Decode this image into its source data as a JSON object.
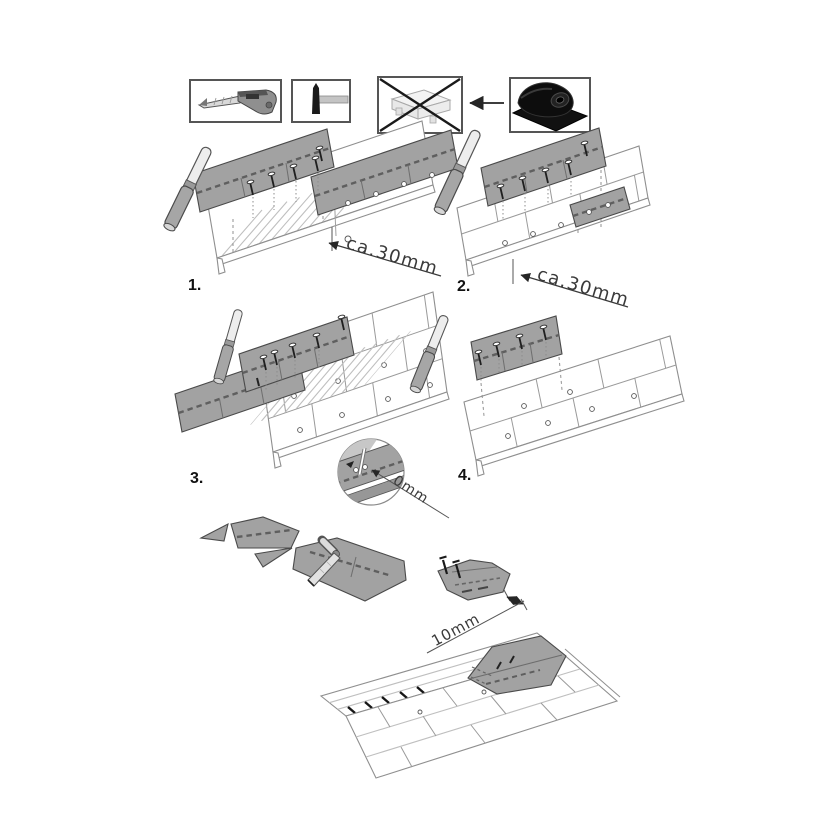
{
  "figure": {
    "background": "#ffffff",
    "tools": {
      "knife_icon": "utility-knife-icon",
      "hammer_icon": "hammer-nail-icon",
      "bundle_icon": "shingle-bundle-crossed-icon",
      "roll_icon": "underlayment-roll-icon"
    },
    "steps": [
      {
        "label": "1.",
        "dimension": "ca.30mm"
      },
      {
        "label": "2.",
        "dimension": "ca.30mm"
      },
      {
        "label": "3.",
        "callout": "0mm"
      },
      {
        "label": "4."
      }
    ],
    "details": {
      "overhang_label": "10mm"
    },
    "colors": {
      "shingle": "#a2a2a2",
      "sealant_dash": "#5f5f5f",
      "shingle_outline": "#4a4a4a",
      "panel_outline": "#8f8f8f",
      "roll_black": "#111111",
      "dimension_text": "#3a3a3a",
      "step_label": "#111111"
    }
  }
}
